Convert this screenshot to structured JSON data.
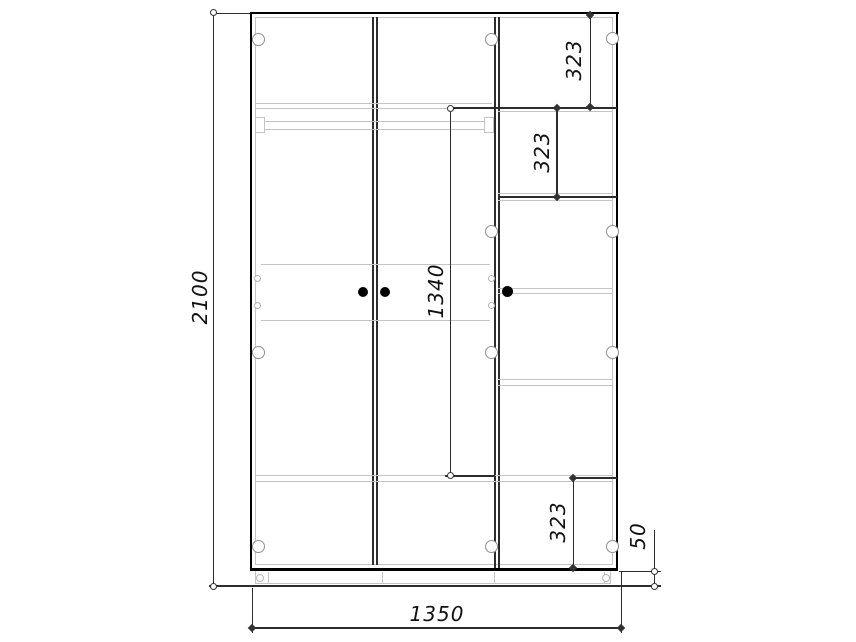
{
  "drawing": {
    "dims": {
      "overall_height": "2100",
      "overall_width": "1350",
      "interior_height": "1340",
      "top_shelf_spacing": "323",
      "upper_shelf_spacing": "323",
      "bottom_shelf_spacing": "323",
      "plinth_height": "50"
    },
    "colors": {
      "line_bold": "#000000",
      "line_dark": "#2d2d2d",
      "line_light": "#c4c4c4",
      "text": "#111111",
      "background": "#ffffff"
    }
  }
}
